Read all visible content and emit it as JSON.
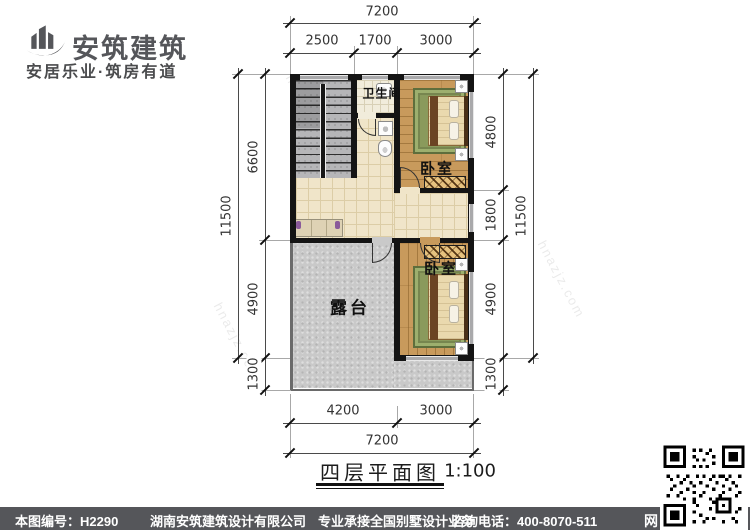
{
  "brand": {
    "name": "安筑建筑",
    "tagline": "安居乐业·筑房有道"
  },
  "plan": {
    "rooms": {
      "bathroom": "卫生间",
      "bedroom_top": "卧室",
      "bedroom_bottom": "卧室",
      "terrace": "露台"
    }
  },
  "dims": {
    "top": {
      "total": "7200",
      "segs": [
        "2500",
        "1700",
        "3000"
      ]
    },
    "bottom": {
      "total": "7200",
      "segs": [
        "4200",
        "3000"
      ]
    },
    "left": {
      "total": "11500",
      "segs": [
        "6600",
        "4900",
        "1300"
      ]
    },
    "right": {
      "total": "11500",
      "segs": [
        "4800",
        "1800",
        "4900",
        "1300"
      ]
    }
  },
  "title": {
    "text": "四层平面图",
    "scale": "1:100"
  },
  "footer": {
    "sheet_label": "本图编号：",
    "sheet_no": "H2290",
    "company": "湖南安筑建筑设计有限公司",
    "service": "专业承接全国别墅设计业务",
    "phone": "咨询电话：400-8070-511",
    "web_badge": "网"
  },
  "watermark": {
    "site": "hnazjz.com",
    "brand": "安筑建筑"
  },
  "colors": {
    "footer_bar": "#55565a",
    "wall": "#141414",
    "wood": "#c89a5c",
    "tile": "#f0e5c9",
    "concrete": "#c9c9c9",
    "stair": "#b6b6b8",
    "rug": "#8a9a5c",
    "logo": "#55565a"
  }
}
